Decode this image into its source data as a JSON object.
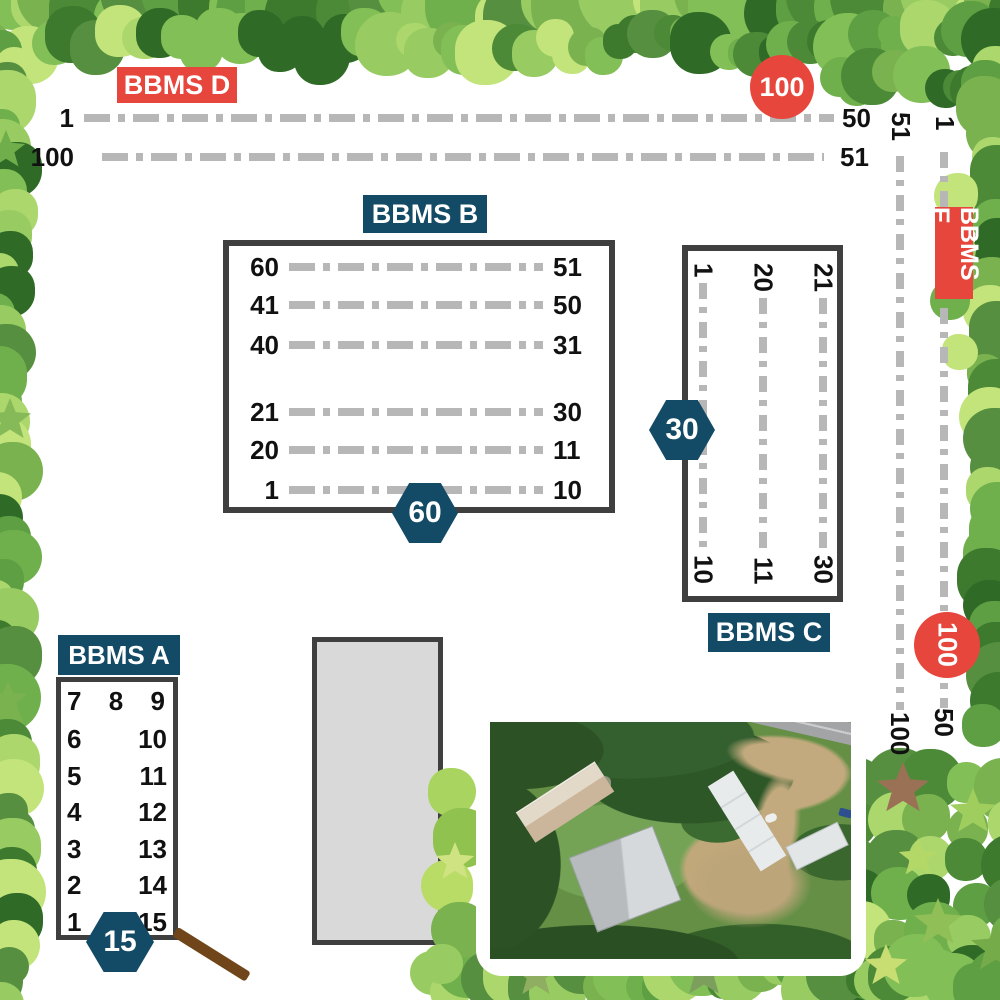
{
  "map": {
    "sections": {
      "bbms_a": {
        "label": "BBMS A",
        "badge": "15",
        "top_row": [
          "7",
          "8",
          "9"
        ],
        "left_column": [
          "6",
          "5",
          "4",
          "3",
          "2",
          "1"
        ],
        "right_column": [
          "10",
          "11",
          "12",
          "13",
          "14",
          "15"
        ]
      },
      "bbms_b": {
        "label": "BBMS B",
        "badge": "60",
        "rows": [
          {
            "left": "60",
            "right": "51"
          },
          {
            "left": "41",
            "right": "50"
          },
          {
            "left": "40",
            "right": "31"
          },
          {
            "left": "21",
            "right": "30"
          },
          {
            "left": "20",
            "right": "11"
          },
          {
            "left": "1",
            "right": "10"
          }
        ]
      },
      "bbms_c": {
        "label": "BBMS C",
        "badge": "30",
        "columns": [
          {
            "top": "1",
            "bottom": "10"
          },
          {
            "top": "20",
            "bottom": "11"
          },
          {
            "top": "21",
            "bottom": "30"
          }
        ]
      },
      "bbms_d": {
        "label": "BBMS D",
        "corner_marker": "100",
        "rows": [
          {
            "left": "1",
            "right": "50"
          },
          {
            "left": "100",
            "right": "51"
          }
        ]
      },
      "bbms_e": {
        "label": "BBMS E",
        "corner_marker": "100",
        "columns": [
          {
            "top": "51",
            "bottom": "100"
          },
          {
            "top": "1",
            "bottom": "50"
          }
        ]
      }
    },
    "colors": {
      "accent_red": "#e7463c",
      "accent_navy": "#134b66",
      "row_dash": "#b7b7b7",
      "outline": "#3f3f3f",
      "building_fill": "#d9d9d9",
      "path_brown": "#6f4519"
    }
  }
}
